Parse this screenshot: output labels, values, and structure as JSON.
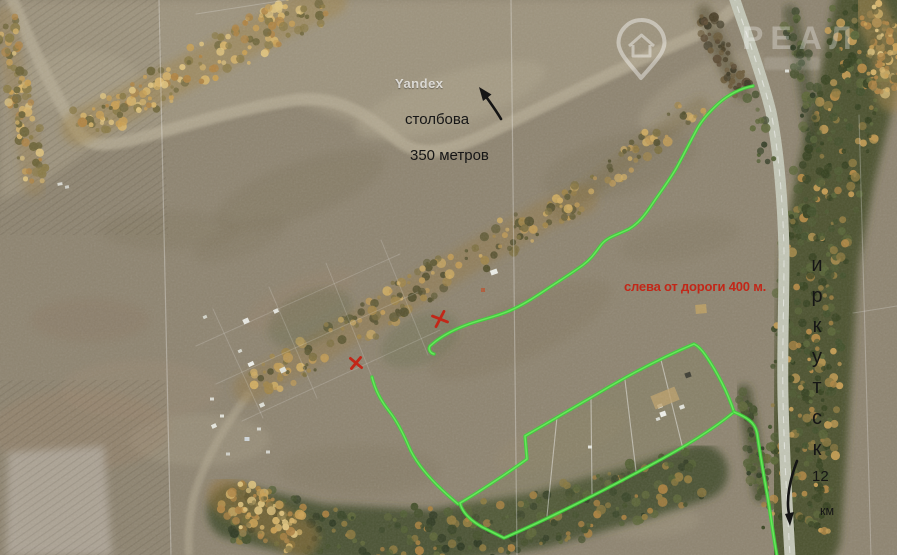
{
  "map": {
    "watermarks": {
      "yandex": "Yandex",
      "agency_text": "РЕАЛ"
    },
    "annotations": {
      "stolbova": {
        "line1": "столбова",
        "line2": "350 метров"
      },
      "road_note": "слева от дороги 400 м.",
      "city_name": "иркутск",
      "city_name_vertical": "и\nр\nк\nу\nт\nс\nк",
      "distance": {
        "value": "12",
        "unit": "км"
      }
    },
    "colors": {
      "route_green": "#3ed23a",
      "route_green_light": "#74ec67",
      "mark_red": "#c22718",
      "label_black": "#161616"
    },
    "routes": {
      "upper_track": {
        "d": "M 753,86 C 741,88 728,95 719,103 C 709,112 701,121 696,131 C 689,144 684,154 677,167 C 669,181 661,191 653,203 C 645,215 639,223 629,229 C 617,235 607,237 601,245 C 595,253 591,259 583,265 C 572,273 559,281 547,289 C 535,297 523,305 509,311 C 495,317 483,319 469,324 C 455,329 444,335 436,341 L 430,346 C 428,349 430,353 434,354"
      },
      "left_connector": {
        "d": "M 372,377 C 375,390 381,401 389,411 C 397,421 403,433 409,447 C 415,461 425,473 437,485 C 445,493 452,499 458,504"
      },
      "plots_loop": {
        "d": "M 694,344 C 663,357 627,376 597,394 C 571,409 546,424 525,436 L 527,459 C 512,470 479,492 460,503 C 462,512 470,520 482,527 L 504,538 C 548,519 601,492 649,466 C 679,450 711,431 734,412 C 728,393 717,372 706,356 C 702,350 698,346 694,344 Z"
      },
      "roadside": {
        "d": "M 734,412 C 746,417 755,422 757,433 C 760,453 764,477 768,499 C 771,519 774,539 777,556"
      }
    },
    "markers": {
      "x1": {
        "transform": "translate(440,319) rotate(-8)"
      },
      "x2": {
        "transform": "translate(356,363) rotate(6)"
      },
      "arrow_top": {
        "shaft_d": "M 501,119 C 497,112 492,105 487,98",
        "head_points": "479,87 491.5,94.5 483,101"
      },
      "arrow_bottom": {
        "shaft_d": "M 797,461 C 790,479 786,499 789,514",
        "head_points": "790,526 794,512 785,514"
      }
    }
  }
}
